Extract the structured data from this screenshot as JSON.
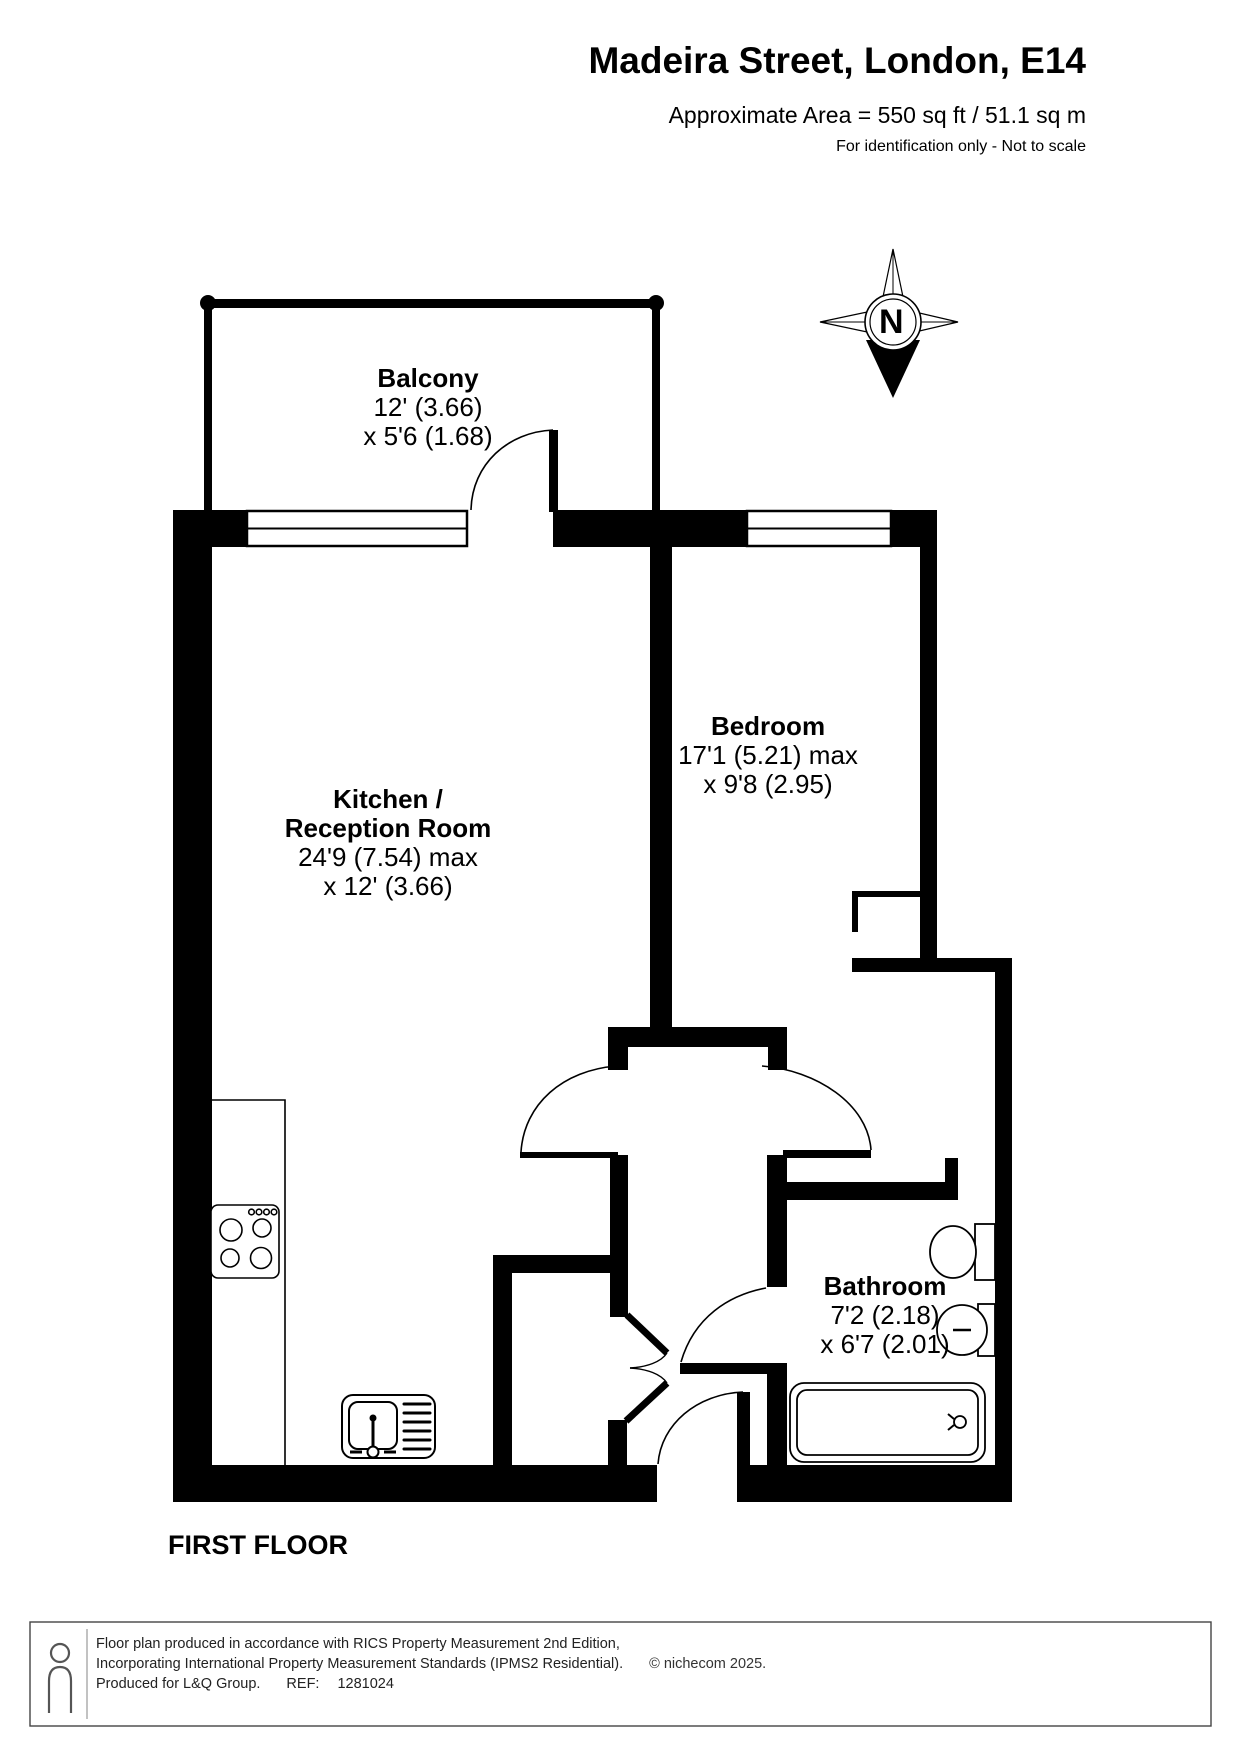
{
  "header": {
    "title": "Madeira Street, London, E14",
    "area_line": "Approximate Area = 550 sq ft / 51.1 sq m",
    "disclaimer": "For identification only - Not to scale"
  },
  "compass": {
    "label": "N"
  },
  "rooms": {
    "balcony": {
      "name": "Balcony",
      "dim1": "12' (3.66)",
      "dim2": "x 5'6 (1.68)"
    },
    "kitchen": {
      "name1": "Kitchen /",
      "name2": "Reception Room",
      "dim1": "24'9 (7.54) max",
      "dim2": "x 12' (3.66)"
    },
    "bedroom": {
      "name": "Bedroom",
      "dim1": "17'1 (5.21) max",
      "dim2": "x 9'8 (2.95)"
    },
    "bathroom": {
      "name": "Bathroom",
      "dim1": "7'2 (2.18)",
      "dim2": "x 6'7 (2.01)"
    }
  },
  "floor_label": "FIRST FLOOR",
  "footer": {
    "line1": "Floor plan produced in accordance with RICS Property Measurement 2nd Edition,",
    "line2": "Incorporating International Property Measurement Standards (IPMS2 Residential).",
    "copyright": "© nichecom 2025.",
    "line3": "Produced for L&Q Group.",
    "ref_label": "REF:",
    "ref_value": "1281024"
  }
}
